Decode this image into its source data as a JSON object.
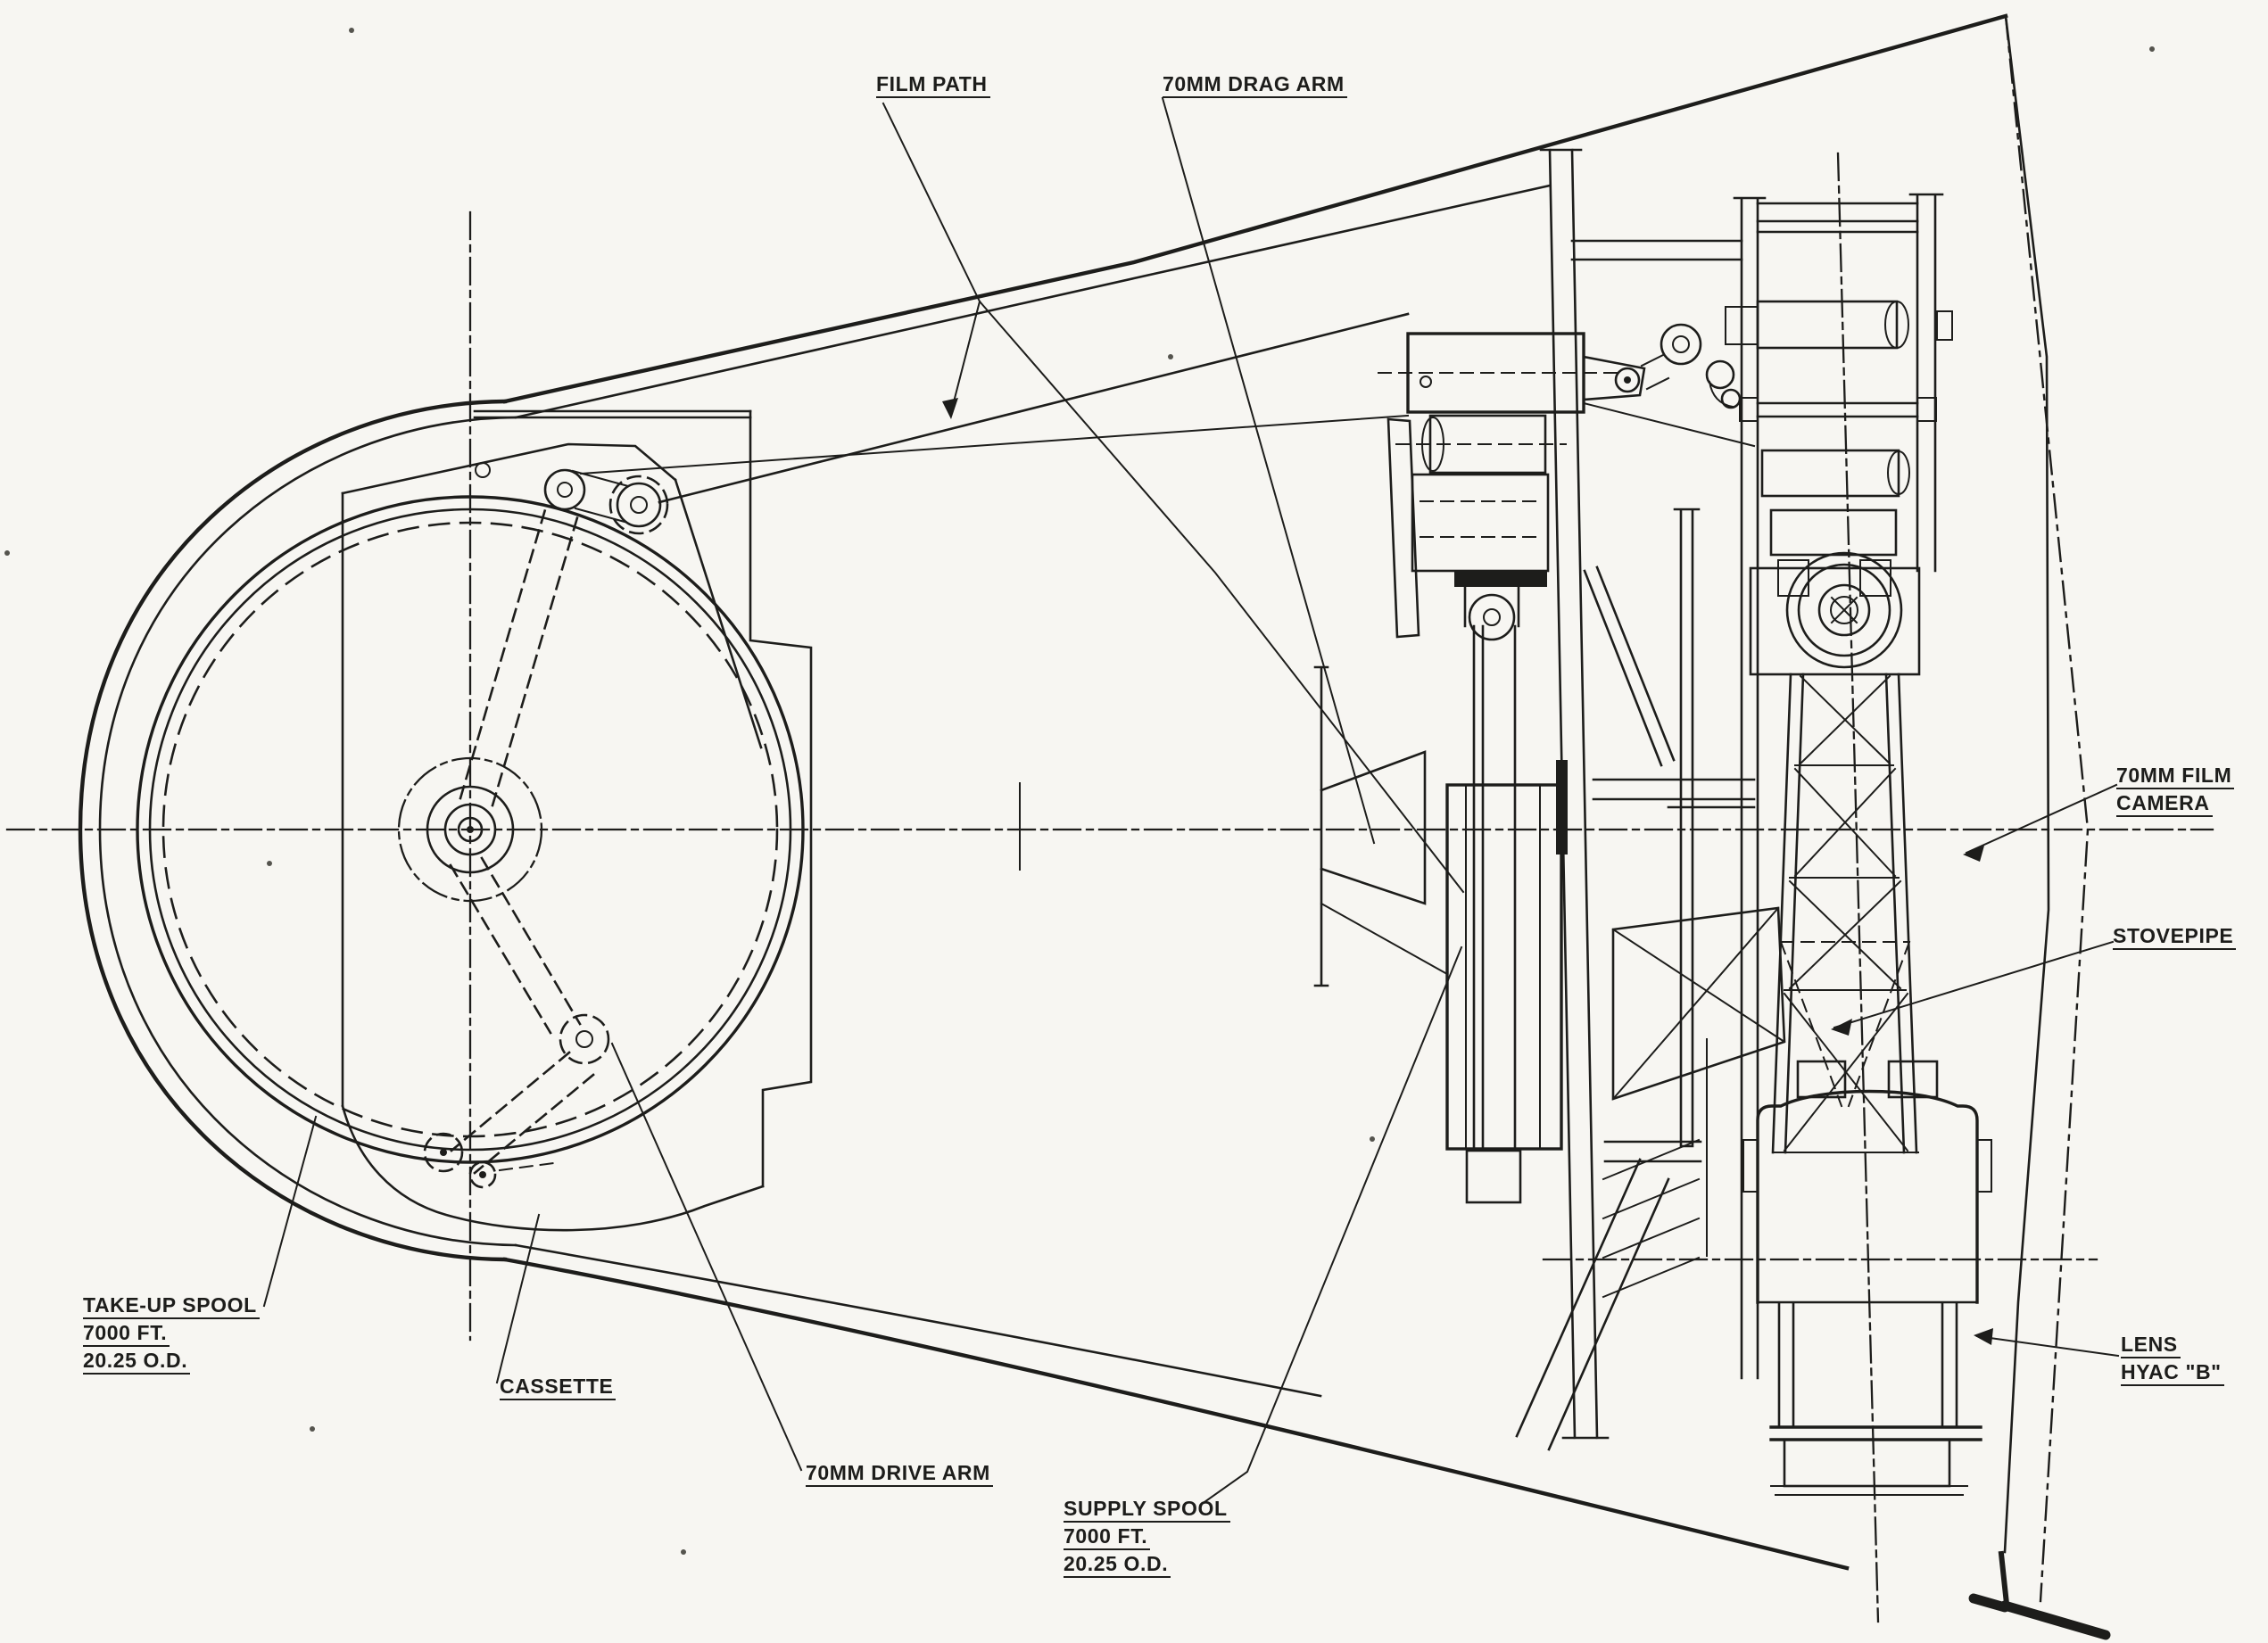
{
  "colors": {
    "ink": "#1d1d1b",
    "paper": "#f7f6f2"
  },
  "labels": {
    "film_path": {
      "lines": [
        "FILM PATH"
      ]
    },
    "drag_arm_70mm": {
      "lines": [
        "70MM DRAG ARM"
      ]
    },
    "film_camera_70mm": {
      "lines": [
        "70MM FILM",
        "CAMERA"
      ]
    },
    "stovepipe": {
      "lines": [
        "STOVEPIPE"
      ]
    },
    "lens_hyac_b": {
      "lines": [
        "LENS",
        "HYAC \"B\""
      ]
    },
    "take_up_spool": {
      "lines": [
        "TAKE-UP SPOOL",
        "7000 FT.",
        "20.25 O.D."
      ]
    },
    "cassette": {
      "lines": [
        "CASSETTE"
      ]
    },
    "drive_arm_70mm": {
      "lines": [
        "70MM DRIVE ARM"
      ]
    },
    "supply_spool": {
      "lines": [
        "SUPPLY SPOOL",
        "7000 FT.",
        "20.25 O.D."
      ]
    }
  }
}
